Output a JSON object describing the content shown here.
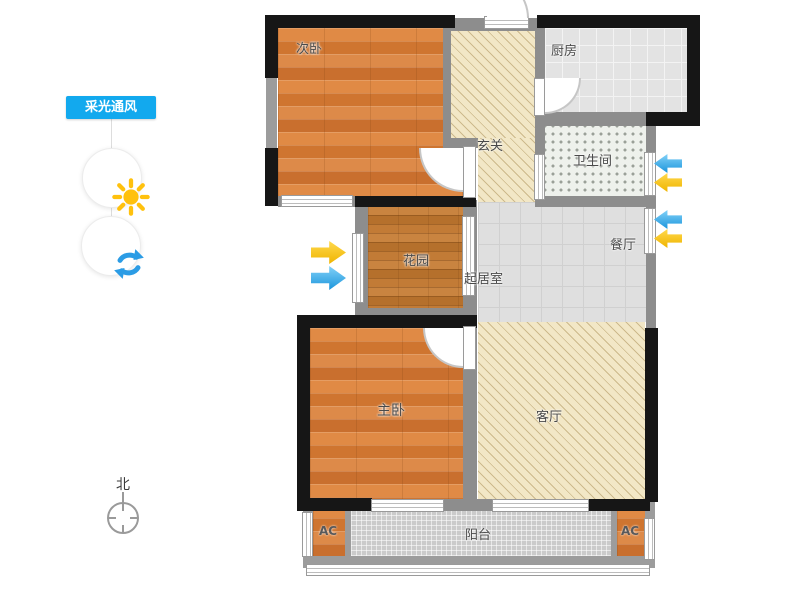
{
  "app": {
    "name": "floor-plan-viewer",
    "mode_panel": "daylight-ventilation"
  },
  "sidebar": {
    "panel_label": "采光通风",
    "panel_color": "#12a9ee",
    "tools": [
      {
        "id": "daylight",
        "icon": "sun-icon",
        "color": "#ffc10d"
      },
      {
        "id": "ventilation",
        "icon": "refresh-icon",
        "color": "#2b9ce5"
      }
    ]
  },
  "compass": {
    "north_label": "北"
  },
  "rooms": {
    "bedroom2": {
      "label": "次卧",
      "floor": "wood"
    },
    "hallway": {
      "label": "玄关",
      "floor": "diagonal-hatch"
    },
    "kitchen": {
      "label": "厨房",
      "floor": "tile"
    },
    "bathroom": {
      "label": "卫生间",
      "floor": "dot-mosaic"
    },
    "garden": {
      "label": "花园",
      "floor": "wood-dark"
    },
    "living_room": {
      "label": "起居室",
      "floor": "tile"
    },
    "dining_room": {
      "label": "餐厅",
      "floor": "tile"
    },
    "master_bedroom": {
      "label": "主卧",
      "floor": "wood"
    },
    "parlor": {
      "label": "客厅",
      "floor": "diagonal-hatch"
    },
    "balcony": {
      "label": "阳台",
      "floor": "mosaic"
    },
    "ac_left": {
      "label": "AC",
      "floor": "wood"
    },
    "ac_right": {
      "label": "AC",
      "floor": "wood"
    }
  },
  "arrows": {
    "daylight_color": "#f2b600",
    "airflow_color": "#1b95dc",
    "west_wall_garden": [
      "daylight-in",
      "airflow-in"
    ],
    "east_wall_bathroom": [
      "airflow-in",
      "daylight-in"
    ],
    "east_wall_dining": [
      "airflow-in",
      "daylight-in"
    ]
  },
  "plan_colors": {
    "exterior_wall": "#161616",
    "interior_wall": "#8d8d8d",
    "wood_floor": "#d9823c",
    "hatch_floor": "#f2e7c6",
    "tile_floor": "#e3e3e3"
  }
}
